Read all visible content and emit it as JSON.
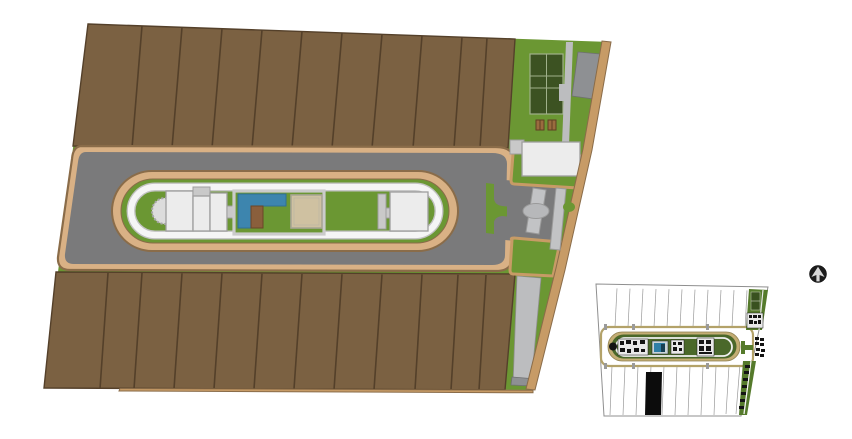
{
  "meta": {
    "title": "Equestrian resort site master plan — color render with key plan inset",
    "kind": "architectural-site-plan"
  },
  "colors": {
    "canvasBg": "#ffffff",
    "plotBrown": "#7b6142",
    "plotLine": "#54402a",
    "lawnGreen": "#6b9733",
    "courtGreen": "#3c5222",
    "tanLight": "#d9b185",
    "tanMid": "#c79b66",
    "tanDark": "#8a6c49",
    "roadGray": "#7a7a7b",
    "pathGray": "#bcbdbf",
    "parkingGray": "#8e9093",
    "buildingWhite": "#ececec",
    "buildingLine": "#9e9e9e",
    "trackWhite": "#f5f5f5",
    "poolBlue": "#3d85ae",
    "deckBrown": "#8a5f3c",
    "sandTan": "#cfc1a1",
    "insetTan": "#b3a269",
    "insetGreen": "#557a2b",
    "insetDarkGreen": "#4a682a",
    "insetCourtGreen": "#39511f",
    "black": "#141414"
  },
  "areas": {
    "site": "Site master plan",
    "plots_north": "North row of residential plots",
    "plots_south": "South row of residential plots",
    "perimeter_road": "Internal perimeter road",
    "racetrack": "Central oval racetrack",
    "infield": "Racetrack infield lawn",
    "clubhouse": "Clubhouse building group",
    "canopy": "Scalloped canopy terrace",
    "pool": "Swimming pool",
    "pool_deck": "Timber pool deck",
    "sand_arena": "Sand arena",
    "stable": "Stable building",
    "tennis_court": "Tennis court",
    "walkway": "Pedestrian walkway",
    "parking": "Parking bay",
    "picnic_tables": "Picnic tables",
    "gatehouse": "Gatehouse building",
    "entrance": "Main entrance gate",
    "median": "Entrance landscape median",
    "boundary": "Perimeter boundary wall",
    "side_path": "Side service path",
    "inset": "Key plan inset (line drawing)",
    "highlighted_plot": "Highlighted plot (selected unit)",
    "north_arrow": "North arrow"
  }
}
